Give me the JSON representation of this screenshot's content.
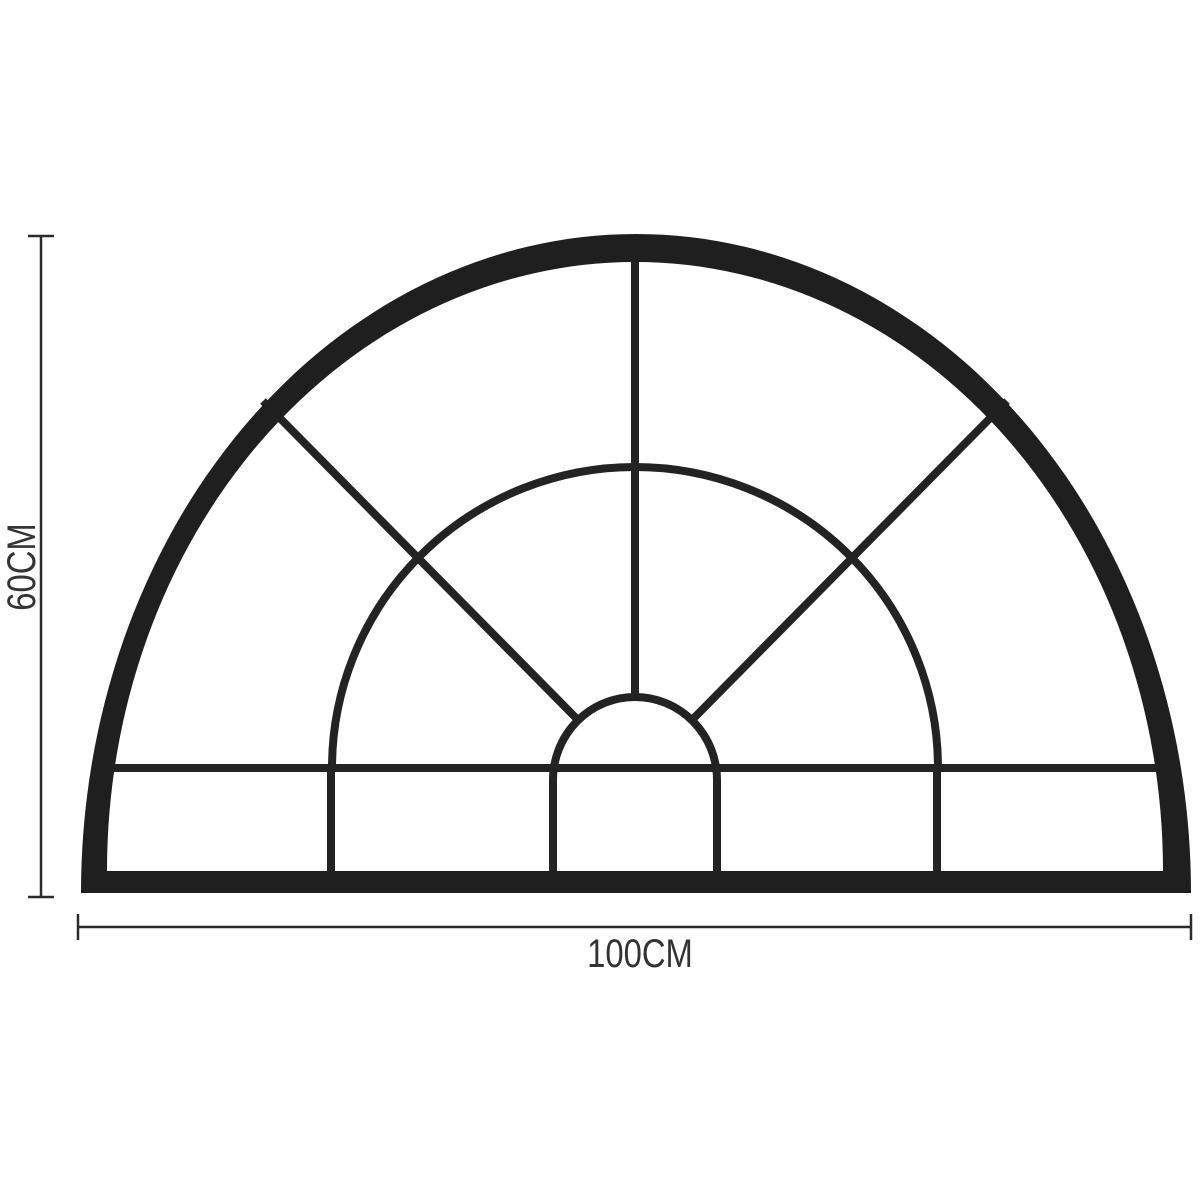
{
  "diagram": {
    "subject": "arched-fanlight-window-frame",
    "colors": {
      "background": "#ffffff",
      "frame": "#1f1f1f",
      "mullion": "#232323",
      "dimension_line": "#2b2b2b",
      "label_text": "#333333"
    }
  },
  "dimensions": {
    "height": {
      "label": "60CM"
    },
    "width": {
      "label": "100CM"
    }
  }
}
